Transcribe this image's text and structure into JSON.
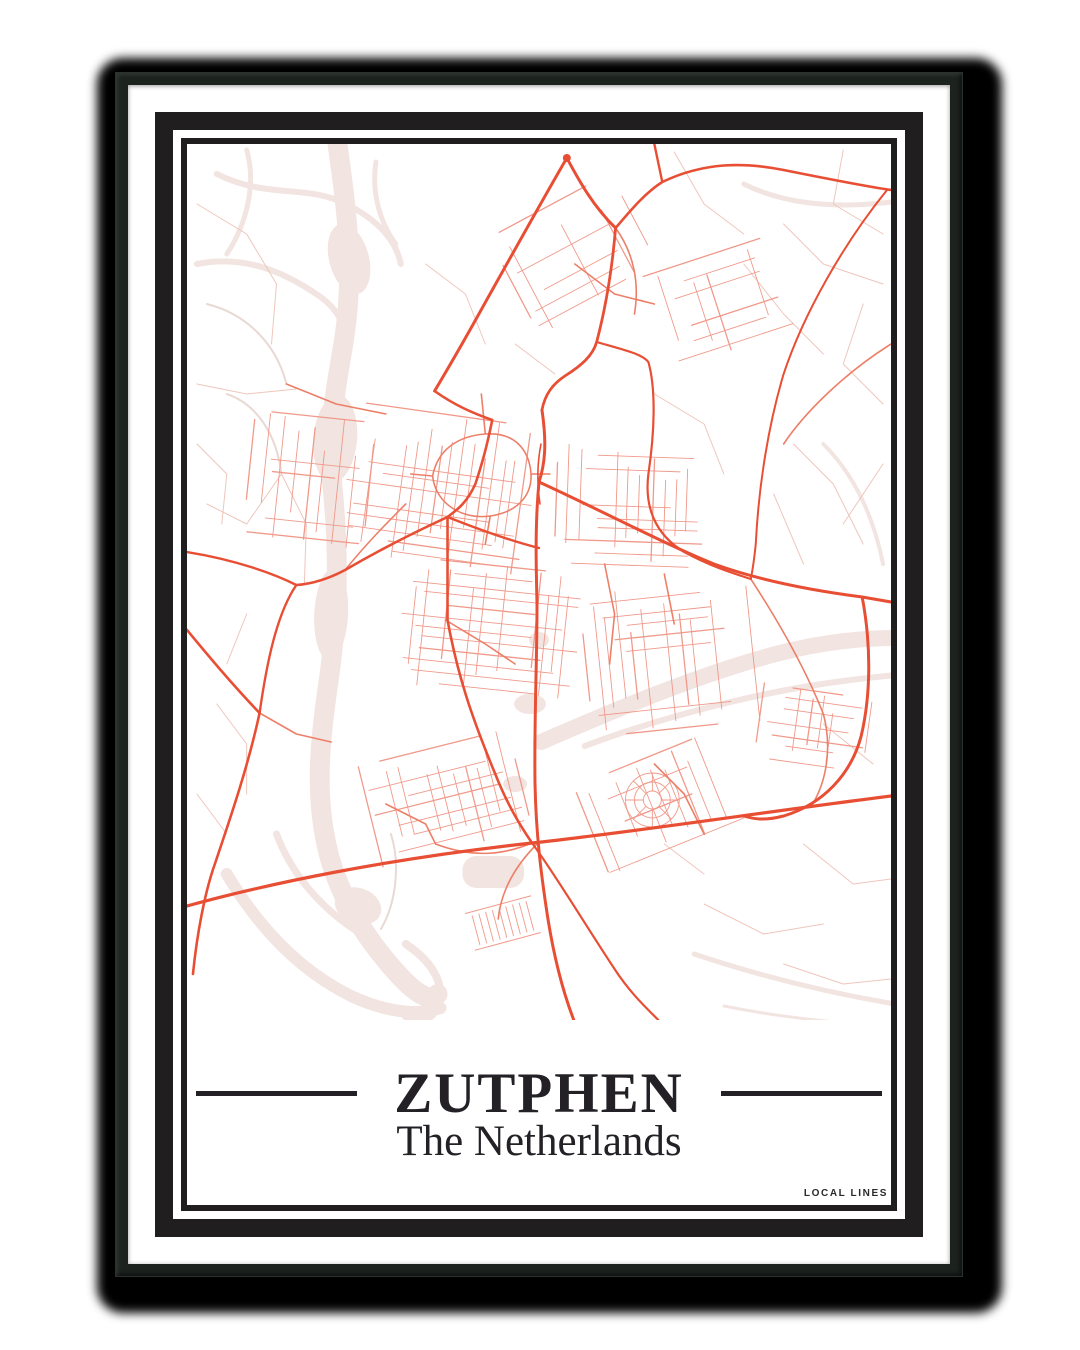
{
  "poster": {
    "title": "ZUTPHEN",
    "subtitle": "The Netherlands",
    "brand": "LOCAL LINES"
  },
  "colors": {
    "page_bg": "#ffffff",
    "shadow": "#000000",
    "frame": "#1c221e",
    "mat": "#ffffff",
    "border_ink": "#211e20",
    "text_ink": "#232126",
    "road_major": "#e84e33",
    "road_medium": "#ed7f68",
    "road_minor": "#f0998a",
    "road_faint": "#eec6bc",
    "landuse": "#f2e4e0",
    "water_line": "#e9d9d4"
  }
}
